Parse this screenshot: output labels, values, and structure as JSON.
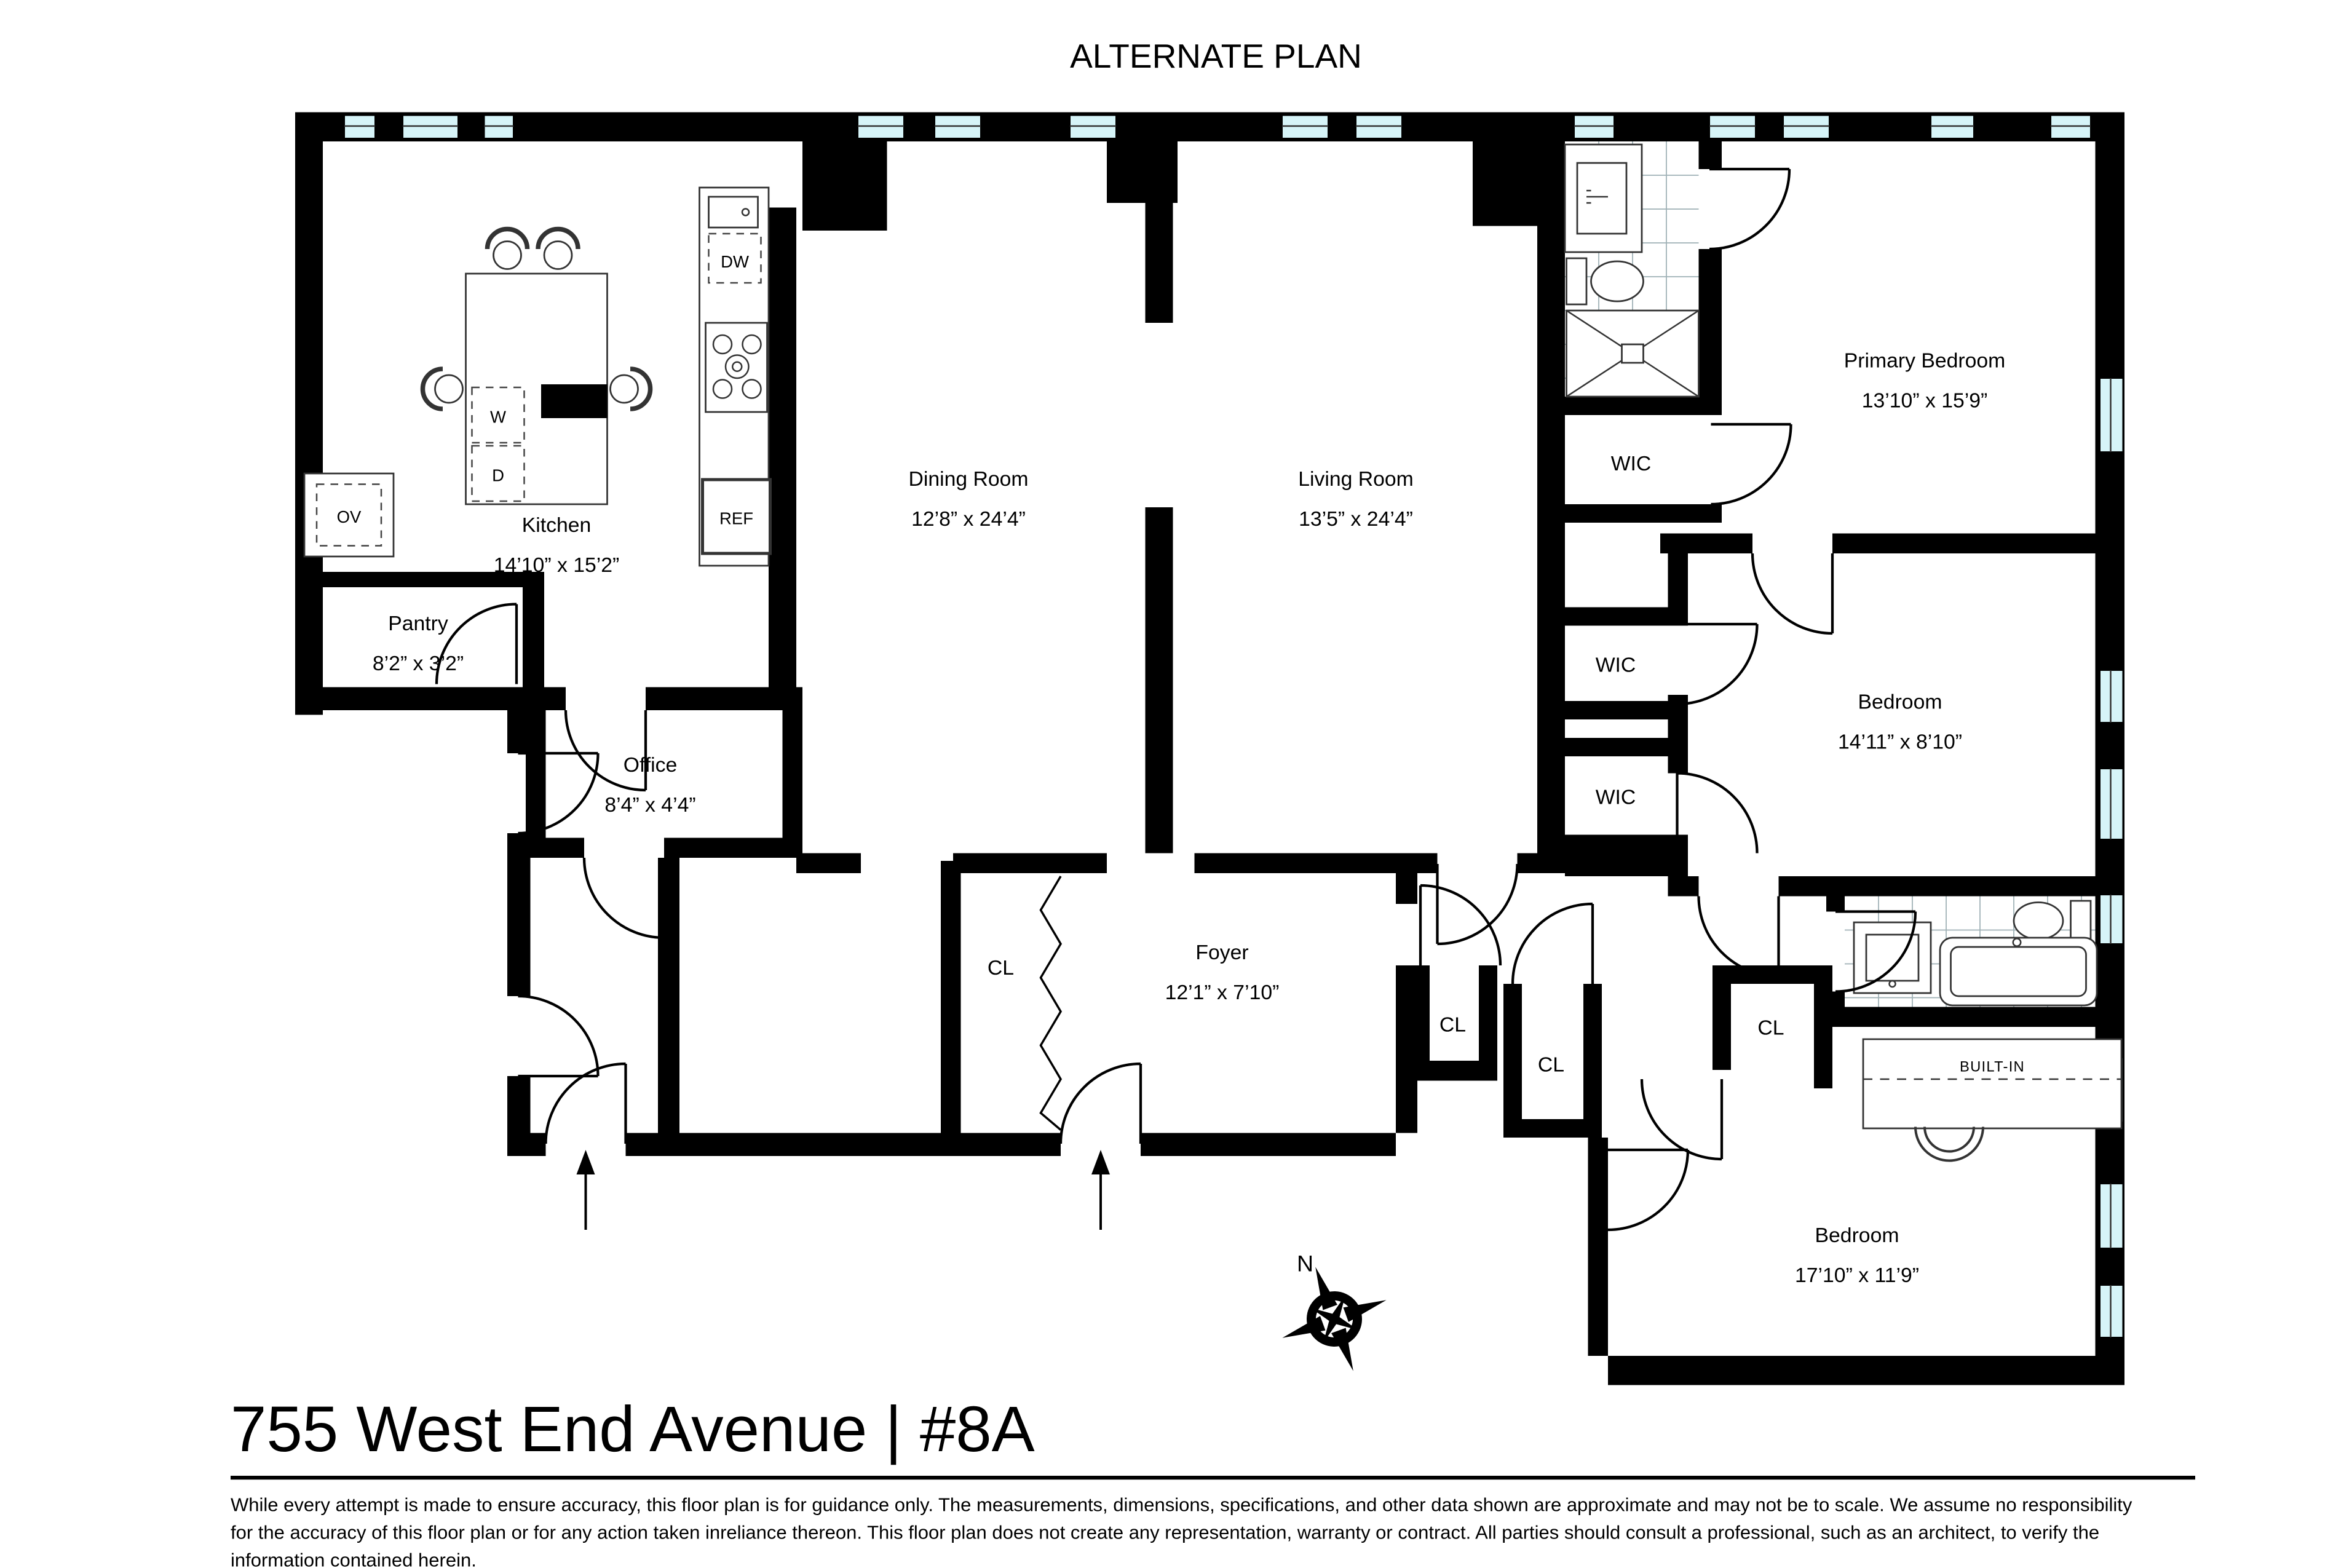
{
  "plan_title": "ALTERNATE PLAN",
  "colors": {
    "wall": "#000000",
    "window": "#d6f4f8",
    "background": "#ffffff"
  },
  "rooms": {
    "kitchen": {
      "name": "Kitchen",
      "dims": "14’10” x 15’2”"
    },
    "pantry": {
      "name": "Pantry",
      "dims": "8’2” x 3’2”"
    },
    "office": {
      "name": "Office",
      "dims": "8’4” x 4’4”"
    },
    "dining": {
      "name": "Dining Room",
      "dims": "12’8” x 24’4”"
    },
    "living": {
      "name": "Living Room",
      "dims": "13’5” x 24’4”"
    },
    "primary_bedroom": {
      "name": "Primary Bedroom",
      "dims": "13’10” x 15’9”"
    },
    "bedroom_mid": {
      "name": "Bedroom",
      "dims": "14’11” x 8’10”"
    },
    "bedroom_bottom": {
      "name": "Bedroom",
      "dims": "17’10” x 11’9”"
    },
    "foyer": {
      "name": "Foyer",
      "dims": "12’1” x 7’10”"
    }
  },
  "closets": {
    "wic_primary": "WIC",
    "wic_2": "WIC",
    "wic_3": "WIC",
    "cl_foyer": "CL",
    "cl_hall_1": "CL",
    "cl_hall_2": "CL",
    "cl_bedroom": "CL"
  },
  "fixtures": {
    "dishwasher": "DW",
    "refrigerator": "REF",
    "oven": "OV",
    "washer": "W",
    "dryer": "D",
    "built_in": "BUILT-IN"
  },
  "compass": {
    "north": "N"
  },
  "footer": {
    "address": "755 West End Avenue | #8A",
    "disclaimer": [
      "While every attempt is made to ensure accuracy, this floor plan is for guidance only. The measurements, dimensions, specifications, and other data shown are approximate and may not be to scale.  We assume no responsibility",
      "for the accuracy of this floor plan or for any action taken inreliance thereon. This floor plan does not create any representation, warranty or contract. All parties should consult a professional, such as an architect, to verify the",
      "information contained herein."
    ]
  }
}
